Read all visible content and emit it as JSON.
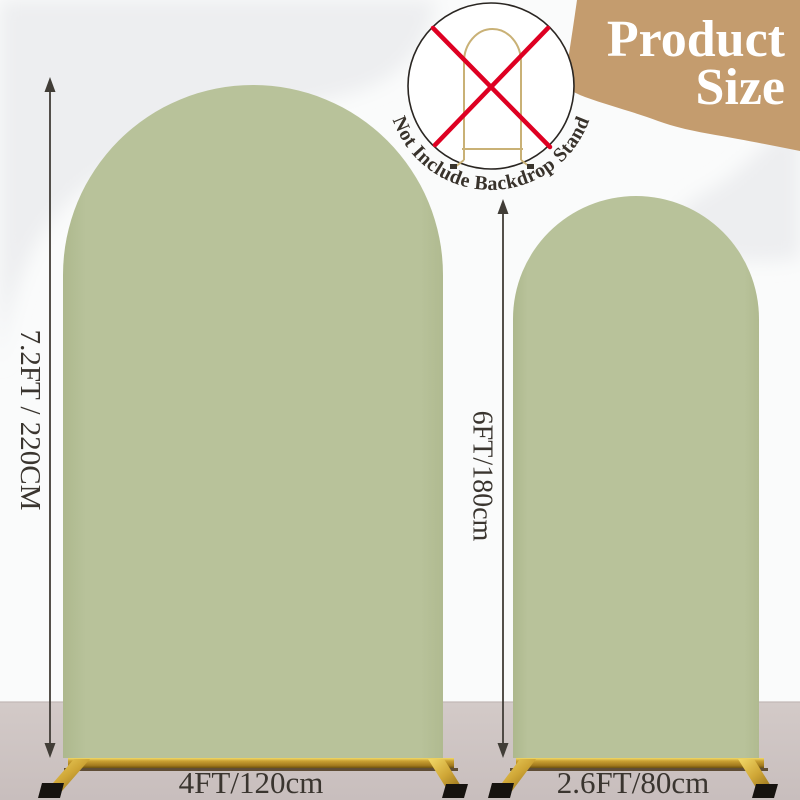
{
  "header": {
    "title_line1": "Product",
    "title_line2": "Size"
  },
  "badge": {
    "label": "Not Include Backdrop Stand",
    "icon": "crossed-out-backdrop-stand"
  },
  "arches": {
    "large": {
      "height_label": "7.2FT / 220CM",
      "width_label": "4FT/120cm"
    },
    "small": {
      "height_label": "6FT/180cm",
      "width_label": "2.6FT/80cm"
    }
  },
  "icons": {
    "dimension_arrow": "double-headed-vertical-arrow",
    "red_cross": "red-x-cross",
    "stand_frame": "gold-arch-backdrop-stand"
  },
  "colors": {
    "tan_blob": "#c49c6e",
    "arch_green": "#b8c29a",
    "floor_top": "#d3cac8",
    "floor_bottom": "#c8bebd",
    "background_gray": "#edeef0",
    "background_white": "#fafbfb",
    "gold_bright": "#f2d968",
    "gold_dark": "#6d5310",
    "red_x": "#de0022",
    "dim_text": "#3a352f",
    "title_white": "#ffffff"
  }
}
